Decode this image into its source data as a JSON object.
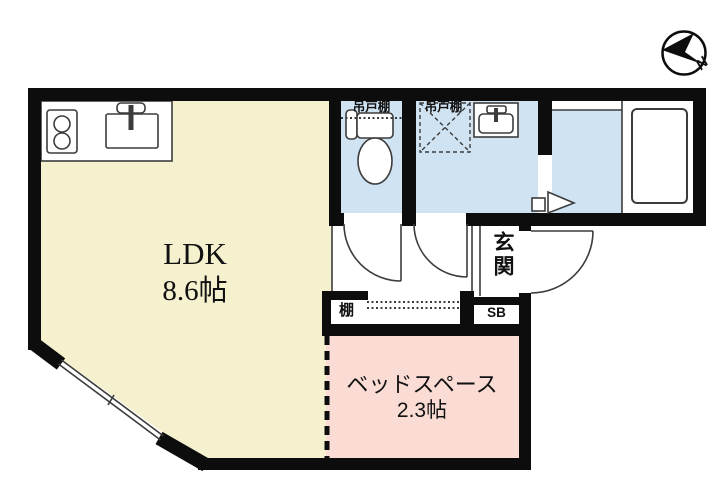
{
  "floorplan": {
    "ldk": {
      "label": "LDK",
      "area": "8.6帖"
    },
    "bed_space": {
      "label": "ベッドスペース",
      "area": "2.3帖"
    },
    "entrance_label": "玄関",
    "shelf_label": "棚",
    "shoebox_label": "SB",
    "toilet_cupboard_label": "吊戸棚",
    "washroom_cupboard_label": "吊戸棚",
    "compass_north_label": "N",
    "colors": {
      "ldk_fill": "#f5f1cf",
      "bed_fill": "#fbdcd5",
      "wet_fill": "#cfe3f3",
      "wall": "#0d0d0d"
    }
  }
}
